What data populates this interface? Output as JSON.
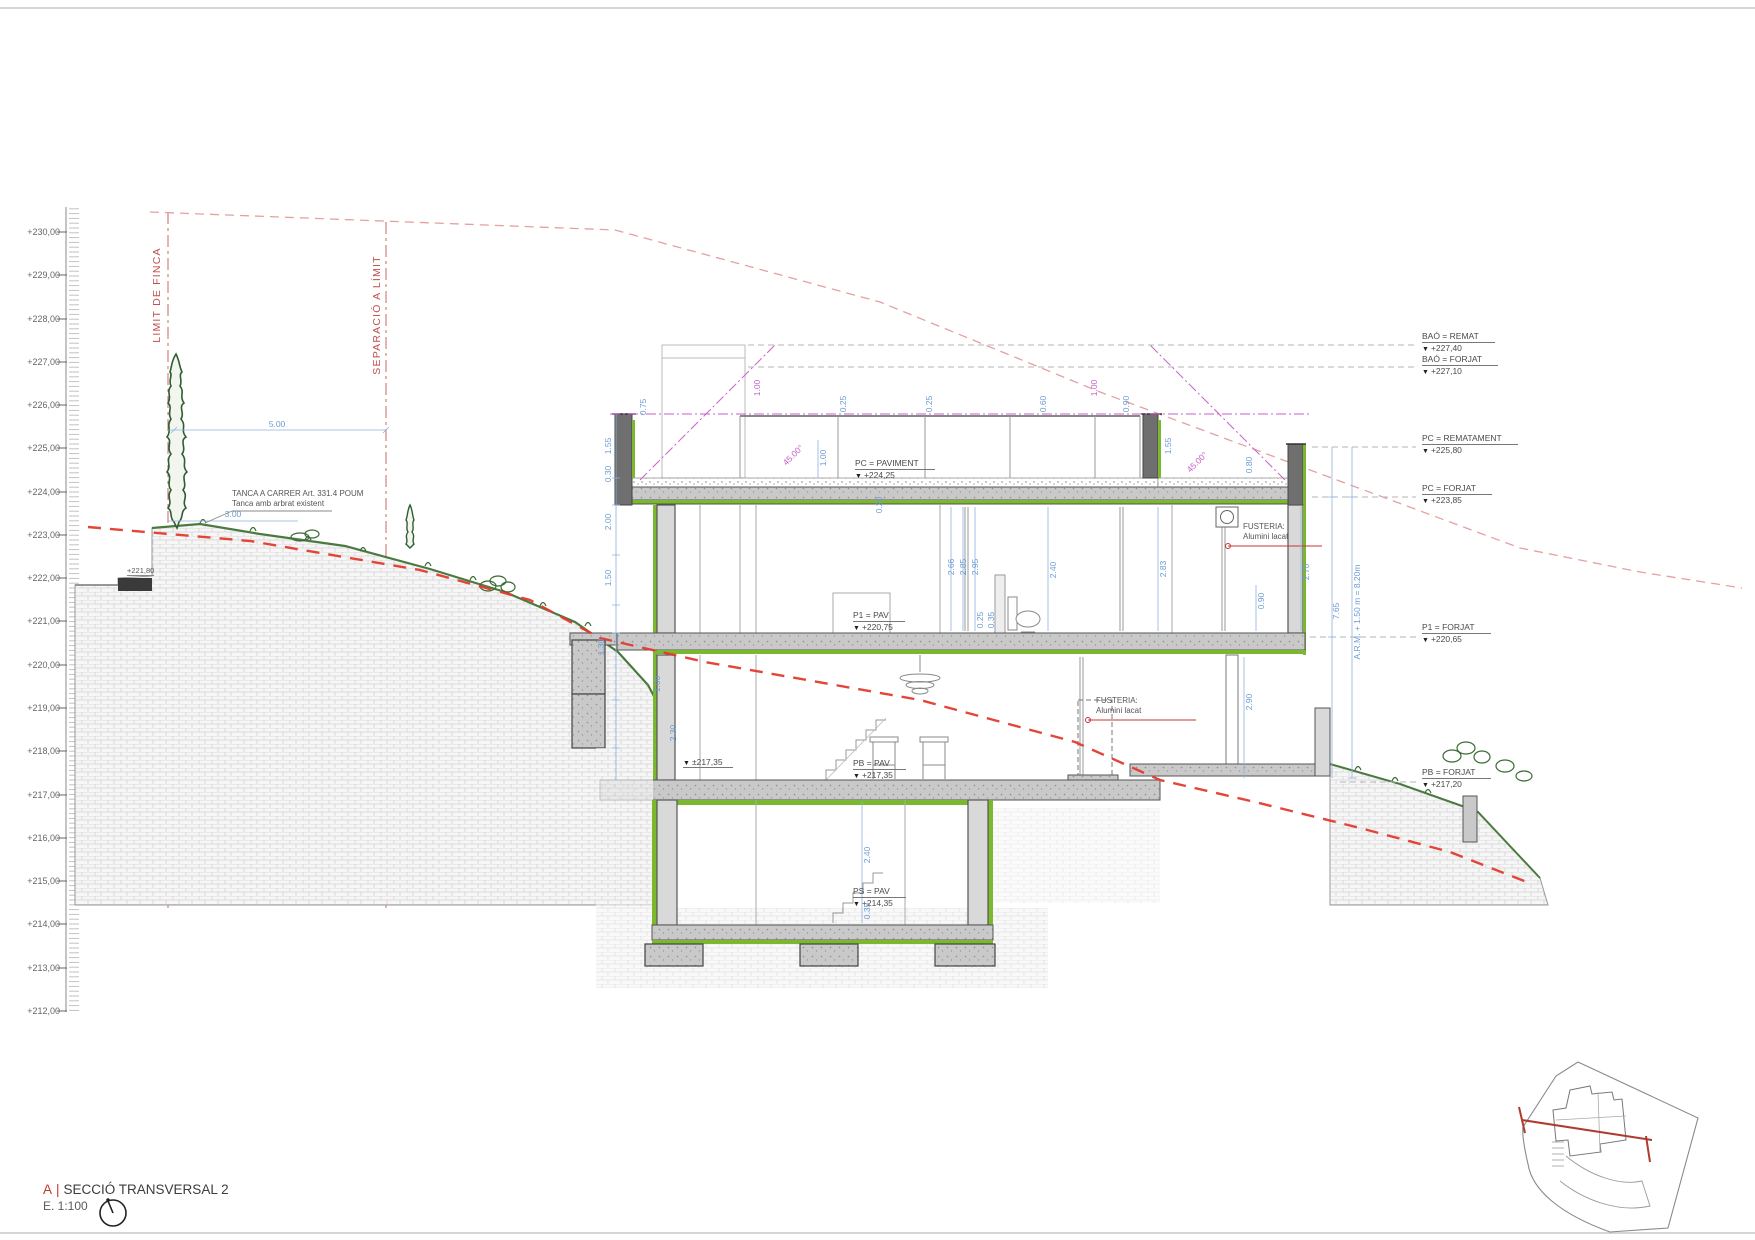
{
  "title_block": {
    "section_letter": "A",
    "separator": "|",
    "title": "SECCIÓ TRANSVERSAL 2",
    "scale_label": "E. 1:100"
  },
  "scale_bar": {
    "labels": [
      "+230,00",
      "+229,00",
      "+228,00",
      "+227,00",
      "+226,00",
      "+225,00",
      "+224,00",
      "+223,00",
      "+222,00",
      "+221,00",
      "+220,00",
      "+219,00",
      "+218,00",
      "+217,00",
      "+216,00",
      "+215,00",
      "+214,00",
      "+213,00",
      "+212,00"
    ]
  },
  "boundaries": {
    "limit": "LIMIT DE FINCA",
    "separation": "SEPARACIÓ A LÍMIT",
    "street_level": "+221,80"
  },
  "notes": {
    "fence_line1": "TANCA A CARRER Art. 331.4 POUM",
    "fence_line2": "Tanca amb arbrat existent",
    "fusteria_line1": "FUSTERIA:",
    "fusteria_line2": "Alumini lacat"
  },
  "levels": {
    "right": [
      {
        "label": "BAÓ = REMAT",
        "value": "+227,40"
      },
      {
        "label": "BAÓ = FORJAT",
        "value": "+227,10"
      },
      {
        "label": "PC = REMATAMENT",
        "value": "+225,80"
      },
      {
        "label": "PC = FORJAT",
        "value": "+223,85"
      },
      {
        "label": "P1 = FORJAT",
        "value": "+220,65"
      },
      {
        "label": "PB = FORJAT",
        "value": "+217,20"
      }
    ],
    "building": [
      {
        "label": "PC = PAVIMENT",
        "value": "+224,25"
      },
      {
        "label": "P1 = PAV",
        "value": "+220,75"
      },
      {
        "label": "PB = PAV",
        "value": "+217,35"
      },
      {
        "label": "PS = PAV",
        "value": "+214,35"
      }
    ],
    "exterior_grade": "±217,35"
  },
  "dims": [
    "5.00",
    "3.00",
    "0.75",
    "1.55",
    "1.00",
    "45.00°",
    "0.25",
    "0.25",
    "0.60",
    "0.90",
    "1.00",
    "45.00°",
    "1.55",
    "0.80",
    "1.00",
    "0.30",
    "2.00",
    "1.50",
    "2.66",
    "2.85",
    "2.95",
    "0.25",
    "0.35",
    "2.40",
    "2.83",
    "2.70",
    "0.90",
    "7.65",
    "A.R.M. + 1.50 m = 8.20m",
    "2.90",
    "1.00",
    "2.30",
    "1.30",
    "0.20",
    "2.40",
    "0.35"
  ],
  "glyphs": {
    "level_triangle": "▼"
  },
  "colors": {
    "boundary_red": "#c0504d",
    "terrain_red": "#e23b2e",
    "envelope_pink": "#e5a0a0",
    "galib_magenta": "#c65fc6",
    "dim_blue": "#6b9bd2",
    "insulation_green": "#7cb82f",
    "vegetation_green": "#2f5d33",
    "concrete_gray": "#c9c9c9",
    "title_red": "#c0392b"
  }
}
